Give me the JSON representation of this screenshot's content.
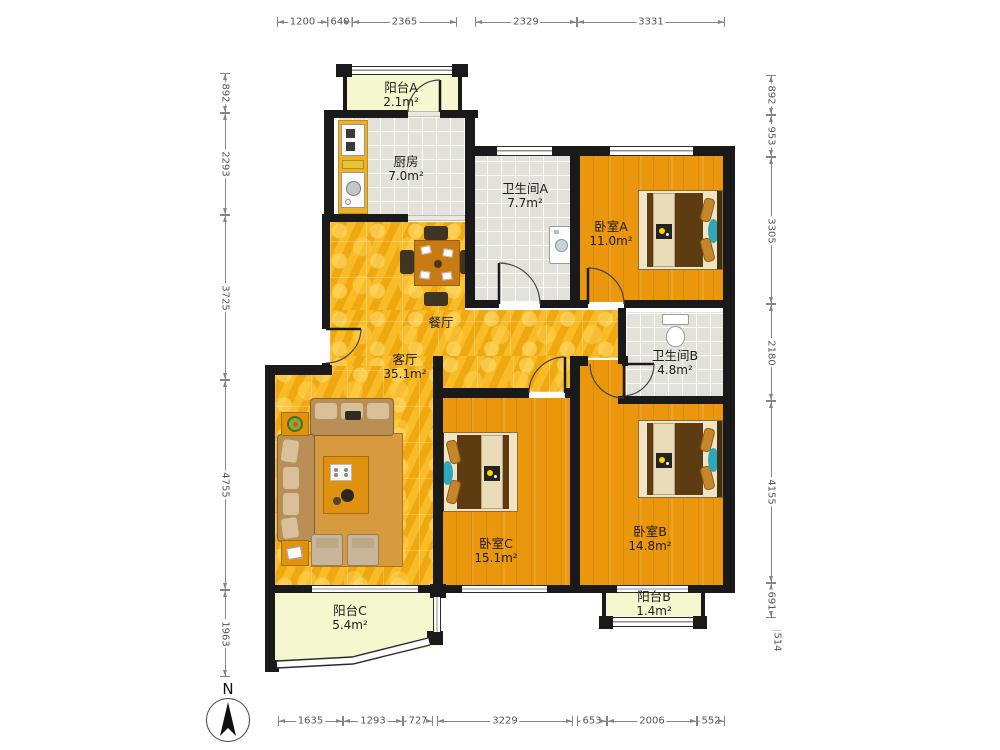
{
  "compass": {
    "label": "N"
  },
  "rooms": [
    {
      "id": "balcony-a",
      "name": "阳台A",
      "area": "2.1m²",
      "x": 401,
      "y": 80
    },
    {
      "id": "kitchen",
      "name": "厨房",
      "area": "7.0m²",
      "x": 406,
      "y": 154
    },
    {
      "id": "bath-a",
      "name": "卫生间A",
      "area": "7.7m²",
      "x": 525,
      "y": 181
    },
    {
      "id": "bedroom-a",
      "name": "卧室A",
      "area": "11.0m²",
      "x": 611,
      "y": 219
    },
    {
      "id": "dining",
      "name": "餐厅",
      "area": "",
      "x": 441,
      "y": 315
    },
    {
      "id": "living",
      "name": "客厅",
      "area": "35.1m²",
      "x": 405,
      "y": 352
    },
    {
      "id": "bath-b",
      "name": "卫生间B",
      "area": "4.8m²",
      "x": 675,
      "y": 348
    },
    {
      "id": "bedroom-c",
      "name": "卧室C",
      "area": "15.1m²",
      "x": 496,
      "y": 536
    },
    {
      "id": "bedroom-b",
      "name": "卧室B",
      "area": "14.8m²",
      "x": 650,
      "y": 524
    },
    {
      "id": "balcony-b",
      "name": "阳台B",
      "area": "1.4m²",
      "x": 654,
      "y": 589
    },
    {
      "id": "balcony-c",
      "name": "阳台C",
      "area": "5.4m²",
      "x": 350,
      "y": 603
    }
  ],
  "dimensions": {
    "top": {
      "axis": "h",
      "pos": 15,
      "segments": [
        {
          "label": "1200",
          "from": 277,
          "to": 328
        },
        {
          "label": "640",
          "from": 328,
          "to": 352
        },
        {
          "label": "2365",
          "from": 352,
          "to": 457
        },
        {
          "label": "2329",
          "from": 475,
          "to": 577
        },
        {
          "label": "3331",
          "from": 577,
          "to": 725
        }
      ]
    },
    "left": {
      "axis": "v",
      "pos": 218,
      "segments": [
        {
          "label": "892",
          "from": 73,
          "to": 113
        },
        {
          "label": "2293",
          "from": 113,
          "to": 215
        },
        {
          "label": "3725",
          "from": 215,
          "to": 380
        },
        {
          "label": "4755",
          "from": 380,
          "to": 590
        },
        {
          "label": "1963",
          "from": 590,
          "to": 677
        }
      ]
    },
    "right": {
      "axis": "v",
      "pos": 764,
      "segments": [
        {
          "label": "892",
          "from": 75,
          "to": 115
        },
        {
          "label": "953",
          "from": 115,
          "to": 157
        },
        {
          "label": "3305",
          "from": 157,
          "to": 304
        },
        {
          "label": "2180",
          "from": 304,
          "to": 401
        },
        {
          "label": "4155",
          "from": 401,
          "to": 583
        },
        {
          "label": "691",
          "from": 583,
          "to": 618
        },
        {
          "label": "514",
          "from": 630,
          "to": 653,
          "bars": true,
          "offset": 6
        }
      ]
    },
    "bottom": {
      "axis": "h",
      "pos": 714,
      "segments": [
        {
          "label": "1635",
          "from": 278,
          "to": 343
        },
        {
          "label": "1293",
          "from": 343,
          "to": 403
        },
        {
          "label": "727",
          "from": 403,
          "to": 433
        },
        {
          "label": "3229",
          "from": 437,
          "to": 573
        },
        {
          "label": "653",
          "from": 577,
          "to": 607
        },
        {
          "label": "2006",
          "from": 607,
          "to": 697
        },
        {
          "label": "552",
          "from": 697,
          "to": 725
        }
      ]
    }
  }
}
